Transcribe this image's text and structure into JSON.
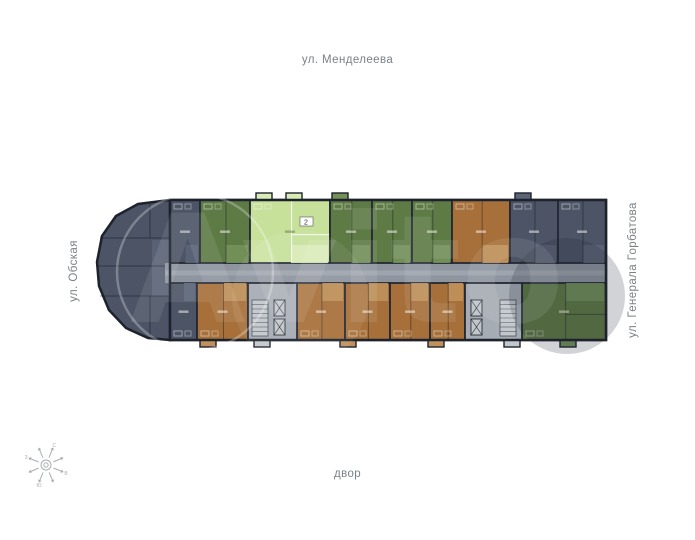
{
  "labels": {
    "top": "ул. Менделеева",
    "left": "ул. Обская",
    "right": "ул. Генерала Горбатова",
    "bottom": "двор"
  },
  "compass": {
    "letters": [
      "С",
      "В",
      "Ю",
      "З"
    ]
  },
  "watermark": {
    "text": "Avito"
  },
  "plan": {
    "palette": {
      "wall": "#232834",
      "outline": "#1d222c",
      "slate": "#4c5466",
      "slateLight": "#5c6578",
      "green": "#5e7a45",
      "greenLight": "#74915a",
      "lime": "#c7e19b",
      "limeLight": "#daecb8",
      "brown": "#a7703a",
      "brownLight": "#c0915c",
      "core": "#a6acb4",
      "coreLight": "#c2c7cd",
      "corridor": "#8e959f"
    },
    "frame": {
      "left": 97,
      "right": 606,
      "top": 200,
      "bottom": 340
    },
    "cap": {
      "color": "slate",
      "points": "170,200 138,204 116,216 102,236 97,262 99,286 109,310 126,328 148,338 170,340",
      "lines": [
        [
          100,
          238,
          170,
          238
        ],
        [
          98,
          266,
          170,
          266
        ],
        [
          100,
          296,
          170,
          296
        ],
        [
          150,
          204,
          150,
          238
        ],
        [
          150,
          296,
          150,
          336
        ]
      ],
      "entry": {
        "x": 152,
        "y": 240,
        "w": 18,
        "h": 56
      }
    },
    "corridor": {
      "x": 165,
      "y": 263,
      "w": 441,
      "h": 20
    },
    "units": [
      {
        "x": 170,
        "y": 200,
        "w": 30,
        "h": 63,
        "c": "slate",
        "lc": "slateLight",
        "row": "top"
      },
      {
        "x": 200,
        "y": 200,
        "w": 50,
        "h": 63,
        "c": "green",
        "lc": "greenLight",
        "row": "top"
      },
      {
        "x": 250,
        "y": 200,
        "w": 80,
        "h": 63,
        "c": "lime",
        "lc": "limeLight",
        "row": "top"
      },
      {
        "x": 330,
        "y": 200,
        "w": 42,
        "h": 63,
        "c": "green",
        "lc": "greenLight",
        "row": "top"
      },
      {
        "x": 372,
        "y": 200,
        "w": 40,
        "h": 63,
        "c": "green",
        "lc": "greenLight",
        "row": "top"
      },
      {
        "x": 412,
        "y": 200,
        "w": 40,
        "h": 63,
        "c": "green",
        "lc": "greenLight",
        "row": "top"
      },
      {
        "x": 452,
        "y": 200,
        "w": 58,
        "h": 63,
        "c": "brown",
        "lc": "brownLight",
        "row": "top"
      },
      {
        "x": 510,
        "y": 200,
        "w": 48,
        "h": 63,
        "c": "slate",
        "lc": "slateLight",
        "row": "top"
      },
      {
        "x": 558,
        "y": 200,
        "w": 48,
        "h": 63,
        "c": "slate",
        "lc": "slateLight",
        "row": "top"
      },
      {
        "x": 170,
        "y": 283,
        "w": 27,
        "h": 57,
        "c": "slate",
        "lc": "slateLight",
        "row": "bottom"
      },
      {
        "x": 197,
        "y": 283,
        "w": 51,
        "h": 57,
        "c": "brown",
        "lc": "brownLight",
        "row": "bottom"
      },
      {
        "x": 297,
        "y": 283,
        "w": 48,
        "h": 57,
        "c": "brown",
        "lc": "brownLight",
        "row": "bottom"
      },
      {
        "x": 345,
        "y": 283,
        "w": 45,
        "h": 57,
        "c": "brown",
        "lc": "brownLight",
        "row": "bottom"
      },
      {
        "x": 390,
        "y": 283,
        "w": 40,
        "h": 57,
        "c": "brown",
        "lc": "brownLight",
        "row": "bottom"
      },
      {
        "x": 430,
        "y": 283,
        "w": 35,
        "h": 57,
        "c": "brown",
        "lc": "brownLight",
        "row": "bottom"
      },
      {
        "x": 522,
        "y": 283,
        "w": 84,
        "h": 57,
        "c": "green",
        "lc": "greenLight",
        "row": "bottom"
      }
    ],
    "cores": [
      {
        "x": 248,
        "y": 283,
        "w": 49,
        "h": 57,
        "stairs": {
          "x": 252,
          "y": 300,
          "w": 16,
          "h": 36
        },
        "lifts": [
          {
            "x": 274,
            "y": 300,
            "w": 11,
            "h": 16
          },
          {
            "x": 274,
            "y": 319,
            "w": 11,
            "h": 16
          }
        ]
      },
      {
        "x": 465,
        "y": 283,
        "w": 57,
        "h": 57,
        "stairs": {
          "x": 500,
          "y": 300,
          "w": 16,
          "h": 36
        },
        "lifts": [
          {
            "x": 471,
            "y": 300,
            "w": 11,
            "h": 16
          },
          {
            "x": 471,
            "y": 319,
            "w": 11,
            "h": 16
          }
        ]
      }
    ],
    "balconies": [
      {
        "x": 256,
        "y": 193,
        "w": 16,
        "h": 8,
        "c": "limeLight"
      },
      {
        "x": 286,
        "y": 193,
        "w": 16,
        "h": 8,
        "c": "limeLight"
      },
      {
        "x": 332,
        "y": 193,
        "w": 16,
        "h": 8,
        "c": "greenLight"
      },
      {
        "x": 515,
        "y": 193,
        "w": 16,
        "h": 8,
        "c": "slateLight"
      },
      {
        "x": 200,
        "y": 339,
        "w": 16,
        "h": 8,
        "c": "brownLight"
      },
      {
        "x": 254,
        "y": 339,
        "w": 16,
        "h": 8,
        "c": "coreLight"
      },
      {
        "x": 340,
        "y": 339,
        "w": 16,
        "h": 8,
        "c": "brownLight"
      },
      {
        "x": 428,
        "y": 339,
        "w": 16,
        "h": 8,
        "c": "brownLight"
      },
      {
        "x": 504,
        "y": 339,
        "w": 16,
        "h": 8,
        "c": "coreLight"
      },
      {
        "x": 560,
        "y": 339,
        "w": 16,
        "h": 8,
        "c": "greenLight"
      }
    ],
    "badge": {
      "x": 300,
      "y": 217,
      "label": "2"
    },
    "watermark_circles": [
      {
        "cx": 195,
        "cy": 272,
        "r": 78,
        "kind": "stroke"
      },
      {
        "cx": 567,
        "cy": 296,
        "r": 58,
        "kind": "dark"
      },
      {
        "cx": 300,
        "cy": 298,
        "r": 68,
        "kind": "light"
      }
    ]
  }
}
